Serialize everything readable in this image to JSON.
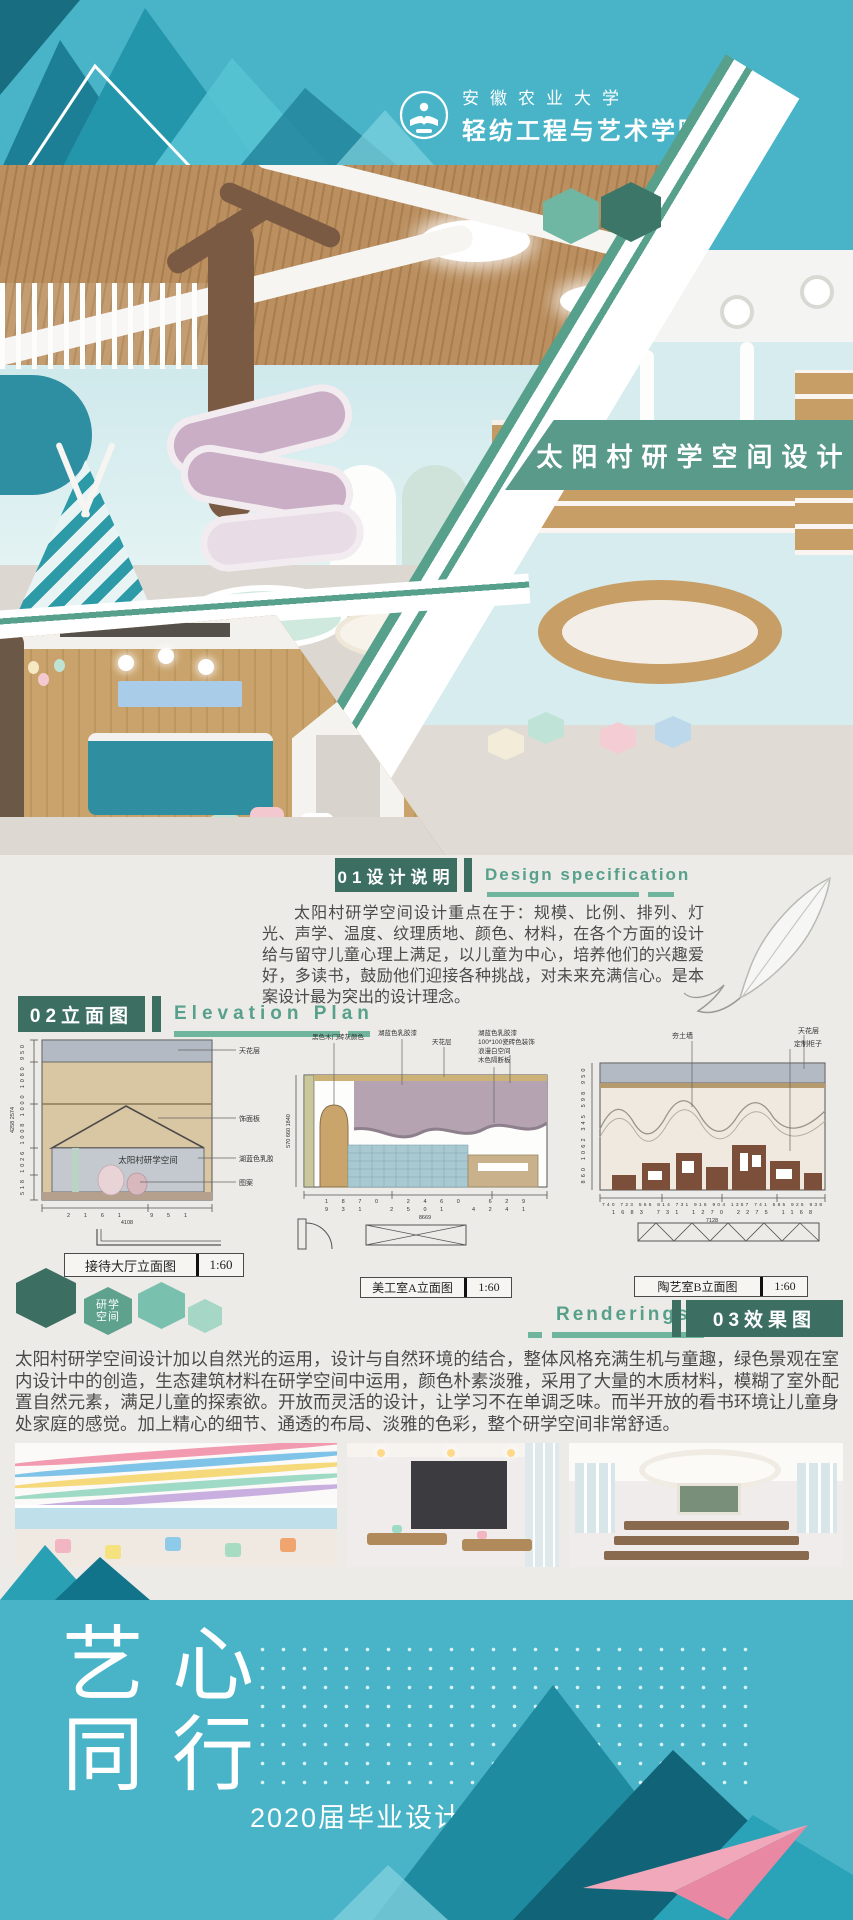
{
  "header": {
    "university": "安徽农业大学",
    "college": "轻纺工程与艺术学院"
  },
  "title_banner": {
    "text": "太阳村研学空间设计"
  },
  "section1": {
    "number": "01设计说明",
    "english": "Design specification",
    "paragraph": "太阳村研学空间设计重点在于：规模、比例、排列、灯光、声学、温度、纹理质地、颜色、材料，在各个方面的设计给与留守儿童心理上满足，以儿童为中心，培养他们的兴趣爱好，多读书，鼓励他们迎接各种挑战，对未来充满信心。是本案设计最为突出的设计理念。"
  },
  "section2": {
    "number": "02立面图",
    "english": "Elevation Plan",
    "hex_badge": {
      "line1": "研学",
      "line2": "空间"
    },
    "drawings": [
      {
        "caption": "接待大厅立面图",
        "scale": "1:60",
        "interior_label": "太阳村研学空间",
        "annotations": [
          "天花层",
          "饰面板",
          "湖蓝色乳胶漆",
          "图案"
        ],
        "dims_v": [
          "518",
          "1026",
          "1008",
          "1000",
          "1080",
          "950"
        ],
        "dims_v_total": [
          "4258",
          "2574"
        ],
        "dims_h": [
          "2161",
          "951"
        ],
        "dims_h_total": [
          "4108"
        ]
      },
      {
        "caption": "美工室A立面图",
        "scale": "1:60",
        "annotations": [
          "黑色木门砖灰颜色",
          "湖蓝色乳胶漆",
          "天花层",
          "湖蓝色乳胶漆",
          "100*100瓷砖色装饰",
          "浪漫白空间",
          "木色隔断板"
        ],
        "dims_v": [
          "570",
          "660",
          "1840"
        ],
        "dims_h": [
          "1870",
          "2460",
          "629"
        ],
        "dims_h2": [
          "931",
          "2501",
          "4241"
        ],
        "dims_h_total": [
          "8669"
        ]
      },
      {
        "caption": "陶艺室B立面图",
        "scale": "1:60",
        "annotations": [
          "夯土墙",
          "天花层",
          "定制柜子"
        ],
        "dims_v": [
          "860",
          "1062",
          "345",
          "598",
          "950"
        ],
        "dims_h": [
          "740",
          "723",
          "566",
          "814",
          "731",
          "916",
          "904",
          "1357",
          "741",
          "585",
          "925",
          "938"
        ],
        "dims_h2": [
          "1683",
          "731",
          "1270",
          "2275",
          "1168"
        ],
        "dims_h_total": [
          "7128"
        ]
      }
    ]
  },
  "section3": {
    "english": "Renderings",
    "number": "03效果图",
    "paragraph": "太阳村研学空间设计加以自然光的运用，设计与自然环境的结合，整体风格充满生机与童趣，绿色景观在室内设计中的创造，生态建筑材料在研学空间中运用，颜色朴素淡雅，采用了大量的木质材料，模糊了室外配置自然元素，满足儿童的探索欲。开放而灵活的设计，让学习不在单调乏味。而半开放的看书环境让儿童身处家庭的感觉。加上精心的细节、通透的布局、淡雅的色彩，整个研学空间非常舒适。"
  },
  "footer": {
    "slogan_line1": "艺心",
    "slogan_line2": "同行",
    "exhibition": "2020届毕业设计作品联展"
  },
  "colors": {
    "teal": "#49b4c8",
    "banner_green": "#5a9a8b",
    "header_box_green": "#3c6e62",
    "accent_green": "#57a08c",
    "dark_teal": "#116478",
    "pink": "#f0a8ba"
  }
}
